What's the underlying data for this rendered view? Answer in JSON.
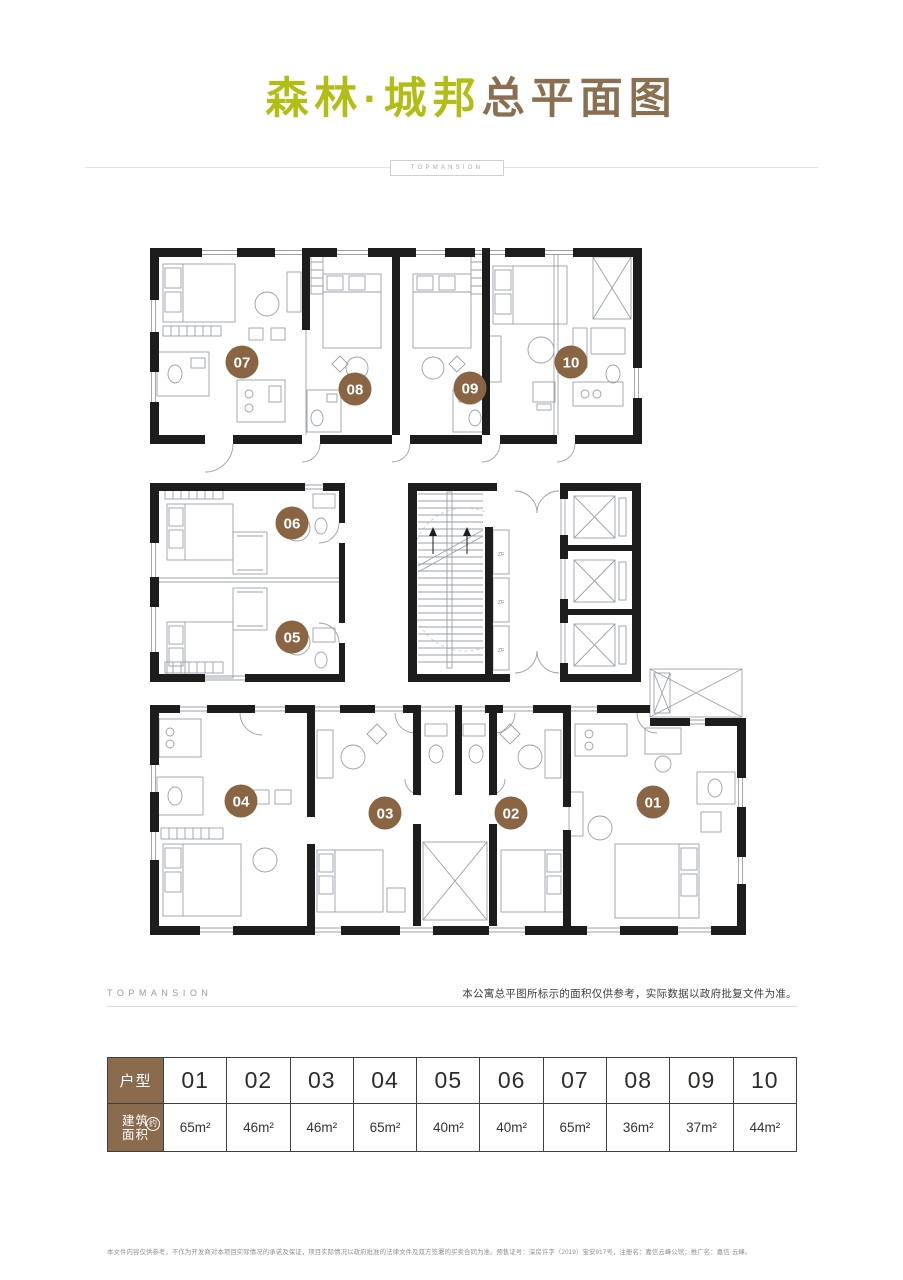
{
  "page": {
    "title_brand": "森林·城邦",
    "title_suffix": "总平面图",
    "brand_en": "TOPMANSION",
    "footer_brand_en": "TOPMANSION",
    "plan_note": "本公寓总平图所标示的面积仅供参考，实际数据以政府批复文件为准。",
    "fine_print": "本文件内容仅供参考，不作为开发商对本项目实际情况的承诺及保证，项目实际情况以政府批准的法律文件及双方签署的买卖合同为准。预售证号：深房许字（2019）宝安917号，注册名：嘉信云峰公馆；推广名：嘉信·云峰。"
  },
  "colors": {
    "brand_green": "#b2bd16",
    "brand_brown": "#8a6f50",
    "badge_brown": "#8a6544",
    "table_header_brown": "#8a6b4d",
    "wall_black": "#1d1d1d",
    "line_gray": "#9aa0a8"
  },
  "floor_plan": {
    "units": [
      {
        "id": "07",
        "x": 97,
        "y": 130
      },
      {
        "id": "08",
        "x": 210,
        "y": 157
      },
      {
        "id": "09",
        "x": 325,
        "y": 156
      },
      {
        "id": "10",
        "x": 426,
        "y": 130
      },
      {
        "id": "06",
        "x": 147,
        "y": 291
      },
      {
        "id": "05",
        "x": 147,
        "y": 405
      },
      {
        "id": "04",
        "x": 96,
        "y": 569
      },
      {
        "id": "03",
        "x": 240,
        "y": 581
      },
      {
        "id": "02",
        "x": 366,
        "y": 581
      },
      {
        "id": "01",
        "x": 508,
        "y": 570
      }
    ],
    "core_labels": [
      {
        "text": "ZF",
        "x": 356,
        "y": 324
      },
      {
        "text": "ZF",
        "x": 356,
        "y": 372
      },
      {
        "text": "ZF",
        "x": 356,
        "y": 420
      }
    ]
  },
  "table": {
    "row1_header": "户型",
    "row2_header_line1": "建筑",
    "row2_header_line2": "面积",
    "row2_header_badge": "约",
    "columns": [
      {
        "unit": "01",
        "area": "65m²"
      },
      {
        "unit": "02",
        "area": "46m²"
      },
      {
        "unit": "03",
        "area": "46m²"
      },
      {
        "unit": "04",
        "area": "65m²"
      },
      {
        "unit": "05",
        "area": "40m²"
      },
      {
        "unit": "06",
        "area": "40m²"
      },
      {
        "unit": "07",
        "area": "65m²"
      },
      {
        "unit": "08",
        "area": "36m²"
      },
      {
        "unit": "09",
        "area": "37m²"
      },
      {
        "unit": "10",
        "area": "44m²"
      }
    ]
  }
}
